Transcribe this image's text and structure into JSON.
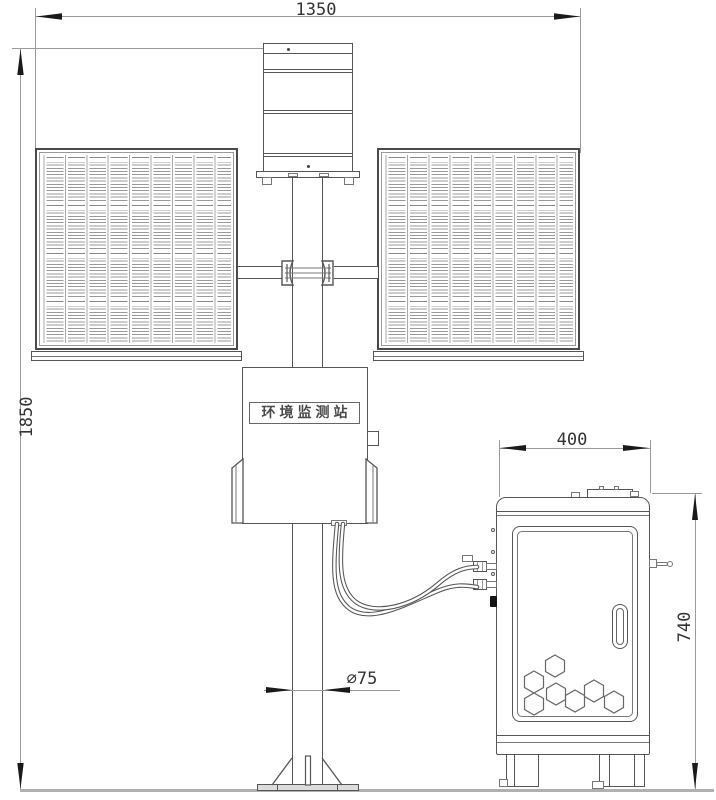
{
  "dimensions": {
    "overall_width": "1350",
    "overall_height": "1850",
    "pole_diameter": "∅75",
    "cabinet_width": "400",
    "cabinet_height": "740"
  },
  "labels": {
    "station_sign": "环境监测站"
  },
  "colors": {
    "structure_line": "#555555",
    "dimension_line": "#9a9a9a",
    "text": "#333333",
    "arrow": "#1a1a1a",
    "ground": "#b0b0b0"
  }
}
